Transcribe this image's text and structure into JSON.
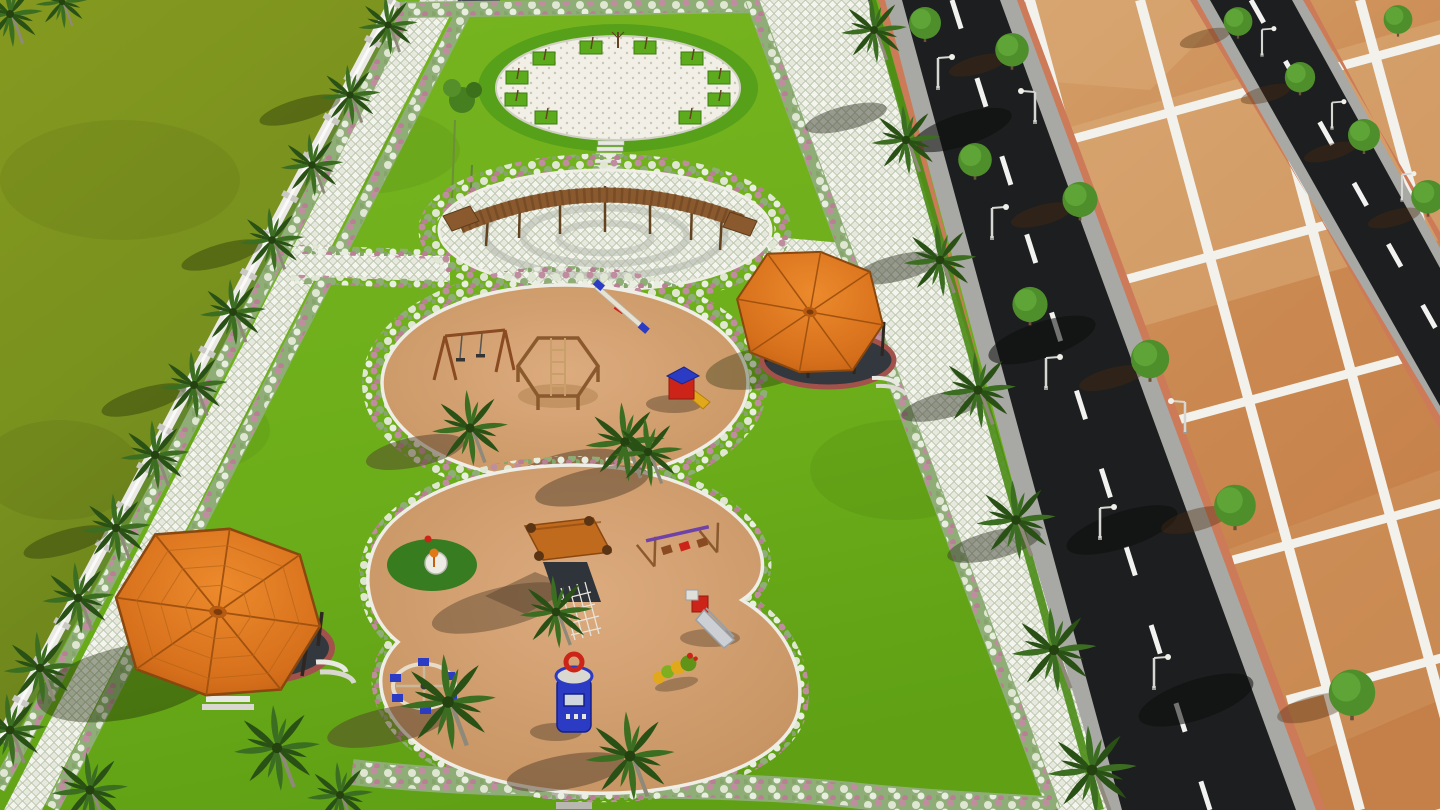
{
  "scene": {
    "description": "Aerial 3D architectural render of a walled landscaped park with a circular paver plaza, curved wooden pergola court, two sand playgrounds with play equipment, two orange-tile-roof gazebos, palm-lined paver walkways, and adjacent vacant residential plots divided by white lines along black asphalt roads",
    "labels": {
      "field": "Open green field outside the boundary wall",
      "boundary_wall": "White compound boundary wall with pillars",
      "park_lawn": "Park lawn",
      "left_walkway": "Paver walkway along the boundary wall with flower borders",
      "right_walkway": "Wide grass-paver walkway along the road",
      "plaza": "Circular white paver plaza ringed by a hedge and young trees",
      "pergola": "Curved wooden pergola over a circular paved seating court",
      "playground_upper": "Upper circular sand playground with swing set, seesaw, hexagonal climber and play tower",
      "playground_lower": "Lower figure-eight sand playground with playhouse, swing set, slide, carousel, kiosk tower and spring riders",
      "gazebo_upper": "Octagonal gazebo with orange tile roof and round dark floor",
      "gazebo_lower": "Large octagonal gazebo with orange tile roof, brick-edged floor and steps",
      "road_main": "Black asphalt road with dashed white center line and curbs",
      "road_upper": "Second asphalt road crossing the plotted land",
      "plots": "Vacant terracotta residential plots divided by white boundary strips",
      "palm_icon": "palm-tree",
      "round_tree_icon": "round-ornamental-tree",
      "street_lamp_icon": "street-light",
      "flower_border": "Pink and white flowering shrub border",
      "stepping_stones": "Stepping-stone path"
    },
    "palette": {
      "field_green": "#7d9420",
      "field_green_dark": "#66801a",
      "lawn_green": "#70b11c",
      "lawn_green_dark": "#5d9c15",
      "hedge_green": "#4a8c16",
      "plaza_hedge": "#57a01a",
      "sand": "#d5a173",
      "sand_dark": "#c08c5e",
      "sand_shadow": "#54402c",
      "paver": "#e9eadf",
      "paver_joint": "#b7c2a4",
      "plaza_paver": "#f1efe6",
      "paver_ring": "#b3b8ab",
      "road": "#1d1e1f",
      "curb": "#a8a8a4",
      "road_line": "#f2f2f0",
      "plot_base": "#cd8a55",
      "plot_light": "#dcae79",
      "plot_line": "#f2f1ec",
      "plot_edge": "#cc7a58",
      "wall": "#eae9e5",
      "wall_pillar": "#c9c8c2",
      "roof_orange": "#dd7721",
      "roof_orange_dark": "#b55a12",
      "roof_edge": "#8a470e",
      "gazebo_floor": "#33383e",
      "brick": "#a3524b",
      "wood": "#8a5a2e",
      "wood_dark": "#63421f",
      "step_white": "#e9e9e4",
      "tree_green": "#4e8f2b",
      "tree_green_light": "#63a83a",
      "palm_green": "#3c6e22",
      "palm_green_dark": "#2a5115",
      "trunk": "#8f897a",
      "flower_pink": "#c08da0",
      "flower_white": "#dfe7d2",
      "flower_leaf": "#8fae77",
      "toy_blue": "#2b3bc4",
      "toy_red": "#cc2418",
      "toy_yellow": "#e2a81c",
      "toy_purple": "#6f42a8",
      "slide_metal": "#ccd0d4",
      "pad_green": "#2e7a1b",
      "shadow": "#1e2a08"
    }
  }
}
